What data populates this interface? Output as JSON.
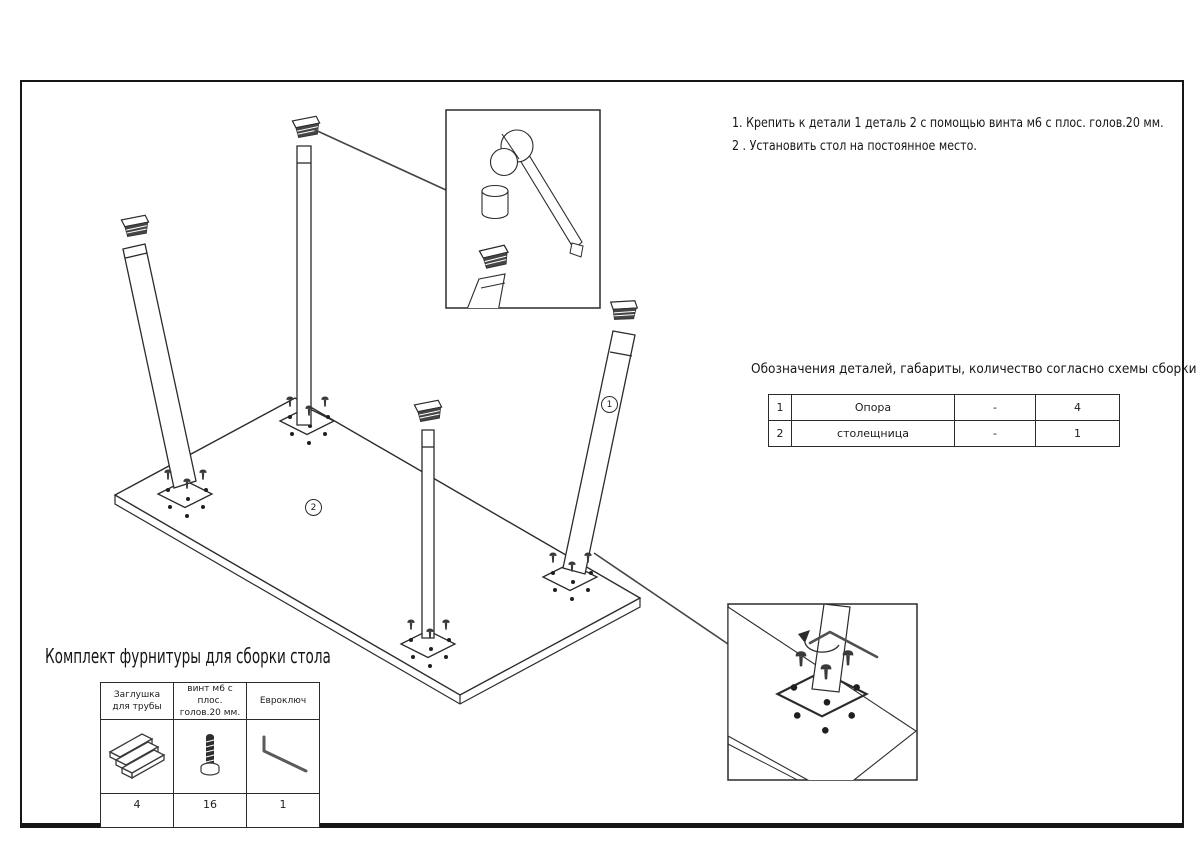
{
  "instructions": {
    "step1": "1. Крепить к детали 1 деталь 2 с помощью винта м6 с плос. голов.20 мм.",
    "step2": "2 . Установить стол на постоянное место."
  },
  "parts_table": {
    "title": "Обозначения деталей, габариты, количество согласно схемы сборки",
    "rows": [
      {
        "num": "1",
        "name": "Опора",
        "size": "-",
        "qty": "4"
      },
      {
        "num": "2",
        "name": "столещница",
        "size": "-",
        "qty": "1"
      }
    ]
  },
  "hardware": {
    "title": "Комплект фурнитуры для сборки стола",
    "items": [
      {
        "name_line1": "Заглушка",
        "name_line2": "для трубы",
        "qty": "4",
        "icon": "tube-cap-icon"
      },
      {
        "name_line1": "винт м6 с плос.",
        "name_line2": "голов.20 мм.",
        "qty": "16",
        "icon": "screw-icon"
      },
      {
        "name_line1": "Евроключ",
        "name_line2": "",
        "qty": "1",
        "icon": "hex-key-icon"
      }
    ]
  },
  "diagram": {
    "leg_label": "1",
    "top_label": "2"
  },
  "colors": {
    "line": "#2b2b2b",
    "dark_fill": "#3a3a3a",
    "paper": "#ffffff"
  }
}
